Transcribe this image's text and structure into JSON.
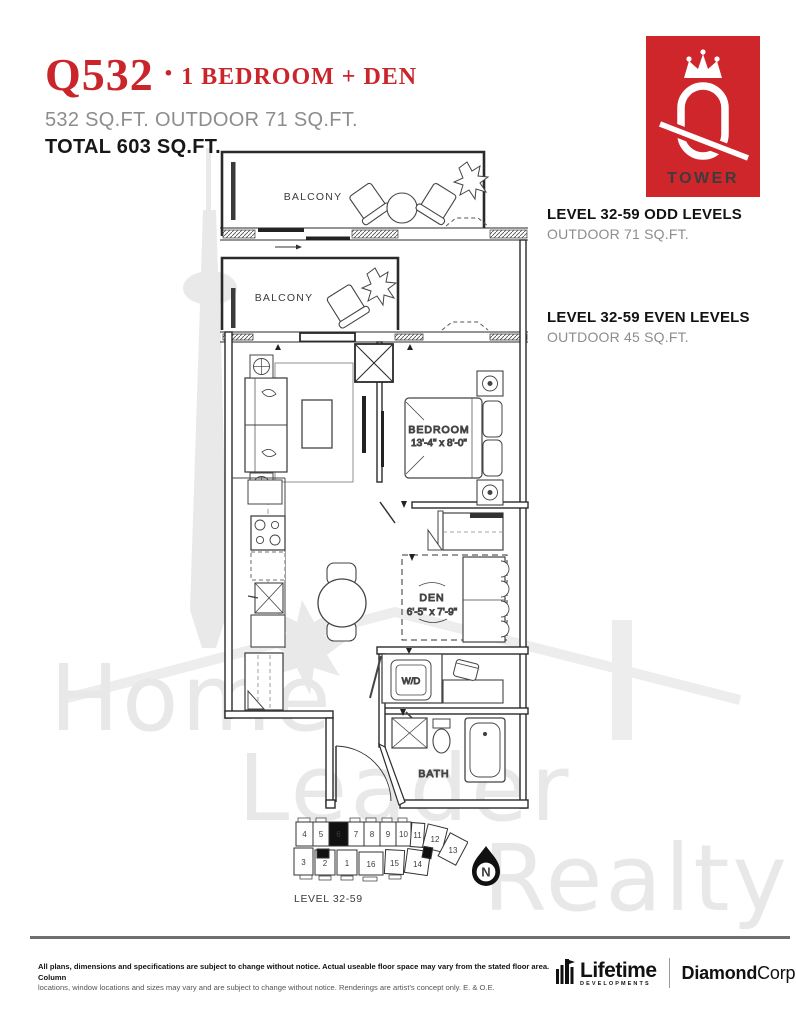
{
  "header": {
    "title_code": "Q532",
    "title_sep": "·",
    "title_type": "1 BEDROOM + DEN",
    "subtitle": "532 SQ.FT. OUTDOOR 71 SQ.FT.",
    "total": "TOTAL 603 SQ.FT.",
    "accent_color": "#c9252b"
  },
  "logo": {
    "tower_label": "TOWER",
    "background_color": "#ce262b"
  },
  "levels": [
    {
      "title": "LEVEL 32-59 ODD LEVELS",
      "subtitle": "OUTDOOR 71 SQ.FT."
    },
    {
      "title": "LEVEL 32-59 EVEN LEVELS",
      "subtitle": "OUTDOOR 45 SQ.FT."
    }
  ],
  "floorplan": {
    "balcony1_label": "BALCONY",
    "balcony2_label": "BALCONY",
    "bedroom_label": "BEDROOM",
    "bedroom_dims": "13'-4\" x 8'-0\"",
    "live_label": "LIVE/COOK/DINE",
    "live_dims": "24'-4\" x 8'-8\"",
    "den_label": "DEN",
    "den_dims": "6'-5\" x 7'-9\"",
    "wd_label": "W/D",
    "bath_label": "BATH"
  },
  "keyplan": {
    "caption": "LEVEL 32-59",
    "highlighted_unit": "6",
    "units": [
      "4",
      "5",
      "6",
      "7",
      "8",
      "9",
      "10",
      "11",
      "12",
      "13",
      "3",
      "2",
      "1",
      "16",
      "15",
      "14"
    ]
  },
  "compass": {
    "label": "N"
  },
  "watermark": {
    "words": [
      "Home",
      "Leader",
      "Realty"
    ]
  },
  "footer": {
    "disclaimer_line1": "All plans, dimensions and specifications are subject to change without notice. Actual useable floor space may vary from the stated floor area. Column",
    "disclaimer_line2": "locations, window locations and sizes may vary and are subject to change without notice. Renderings are artist's concept only. E. & O.E.",
    "brand1_name": "Lifetime",
    "brand1_sub": "DEVELOPMENTS",
    "brand2_bold": "Diamond",
    "brand2_rest": "Corp"
  }
}
